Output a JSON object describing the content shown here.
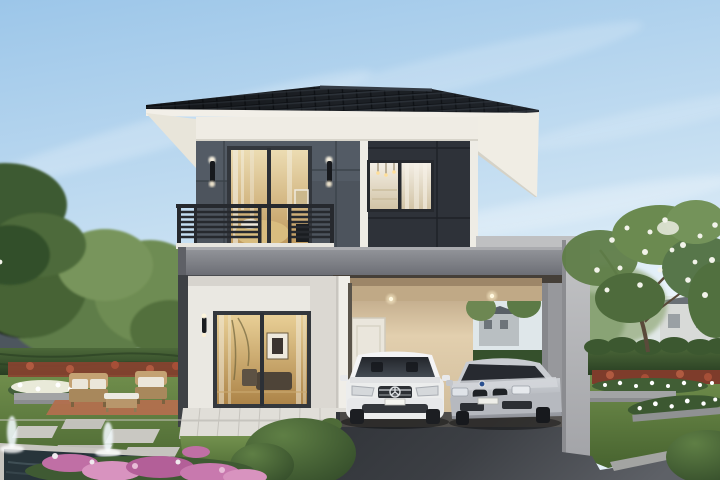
{
  "image": {
    "title": "Architectural rendering of a modern two-story house with carport, two sedans and landscaped garden",
    "type": "architectural-visualization",
    "width_px": 720,
    "height_px": 480
  },
  "scene": {
    "sky": "clear blue sky with soft diagonal clouds",
    "house": {
      "floors": 2,
      "roof": "black tiled hip roof with white fascia",
      "upper_wall_left": "gray panel siding with balcony",
      "upper_wall_right": "charcoal panel siding with picture window",
      "features": [
        "balcony with dark metal slat railing",
        "upstairs sliding glass door with warm bedroom interior",
        "upstairs window with white kitchen interior and pendant lights",
        "black up-down wall sconces",
        "first-floor picture window with warm living room interior",
        "gray flat-roof carport with recessed downlights",
        "white paneled entry door",
        "white tiled terrace"
      ]
    },
    "vehicles": [
      {
        "name": "white sedan",
        "position": "left carport bay",
        "view": "front"
      },
      {
        "name": "silver sedan",
        "position": "right carport bay",
        "view": "three-quarter front"
      }
    ],
    "garden_left": [
      "lawn",
      "trimmed dark hedge",
      "red flowering shrub border",
      "white flower bed with gray planter wall",
      "wicker outdoor sofa, armchair and coffee table on terracotta pavers",
      "gray stepping stones",
      "dark fountain pool with two water jets",
      "pink flower bed"
    ],
    "garden_right": [
      "frangipani tree with white blossoms",
      "trimmed hedge",
      "red shrub border",
      "two white flower beds with gray planter walls",
      "low rounded hedge",
      "lawn"
    ],
    "foreground": [
      "dark gray driveway",
      "large rounded hedge mound",
      "stone curb"
    ],
    "background": [
      "neighboring gray house at left",
      "trees",
      "distant white house at right"
    ]
  },
  "colors": {
    "sky-top": "#9cc6e9",
    "sky-low": "#eaf4fb",
    "roof-tile": "#1d2126",
    "fascia-white": "#f2efe8",
    "frieze": "#efece4",
    "wall-upper-left": "#4d545d",
    "wall-upper-right": "#2e3239",
    "trim-white": "#eeece5",
    "railing-dark": "#26292e",
    "band-gray": "#85878c",
    "parapet-light": "#bfc0c2",
    "pillar-light": "#b3b4b6",
    "wall-white": "#eae8e2",
    "carport-beige": "#d3bf9e",
    "door-white": "#eae6dc",
    "glass-dark": "#2b2f35",
    "interior-warm": "#dcbd82",
    "interior-white": "#f1ece2",
    "driveway-dark": "#303338",
    "driveway-light": "#585b61",
    "grass": "#617f41",
    "hedge-dark": "#2f4628",
    "tree-green": "#5d7b45",
    "flower-pink": "#c06fa5",
    "flower-white": "#f2f3ea",
    "flower-red": "#8a4330",
    "planter-gray": "#a2a4a5",
    "paver-terracotta": "#b26f4e",
    "wicker": "#c4a273",
    "cushion": "#ebe6da",
    "water-dark": "#27343a",
    "car-white": "#eceded",
    "car-silver": "#babdc3"
  }
}
